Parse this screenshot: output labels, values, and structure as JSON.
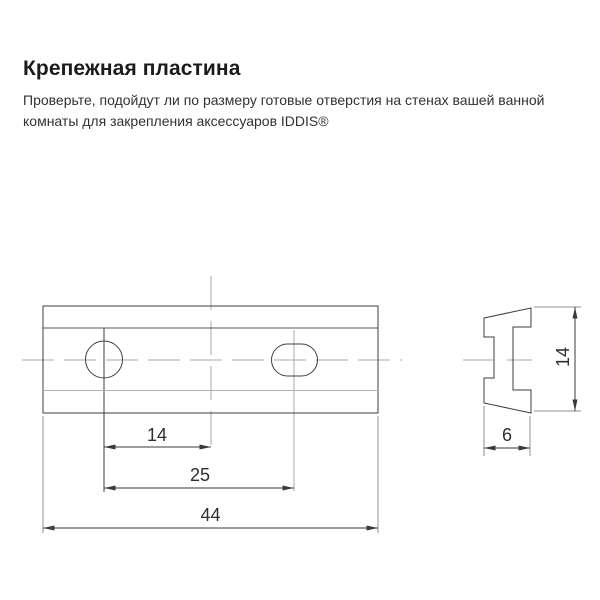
{
  "header": {
    "title": "Крепежная пластина",
    "description": "Проверьте, подойдут ли по размеру готовые отверстия на стенах вашей ванной комнаты для закрепления аксессуаров IDDIS®"
  },
  "drawing": {
    "type": "technical-drawing-two-views",
    "views": {
      "front": {
        "name": "front-view-mounting-plate",
        "dim_hole_to_center": "14",
        "dim_hole_spacing": "25",
        "dim_total_width": "44",
        "holes": [
          "round-hole",
          "slotted-hole"
        ]
      },
      "side": {
        "name": "side-profile-view",
        "dim_depth": "6",
        "dim_height": "14"
      }
    },
    "colors": {
      "outline": "#3f3f3f",
      "inner_edge_dark": "#555555",
      "inner_edge_light": "#b2b2b2",
      "centerline": "#a8a8a8",
      "extension_line": "#8f8f8f",
      "dimension_line": "#3a3a3a",
      "dimension_text": "#2e2e2e"
    }
  }
}
